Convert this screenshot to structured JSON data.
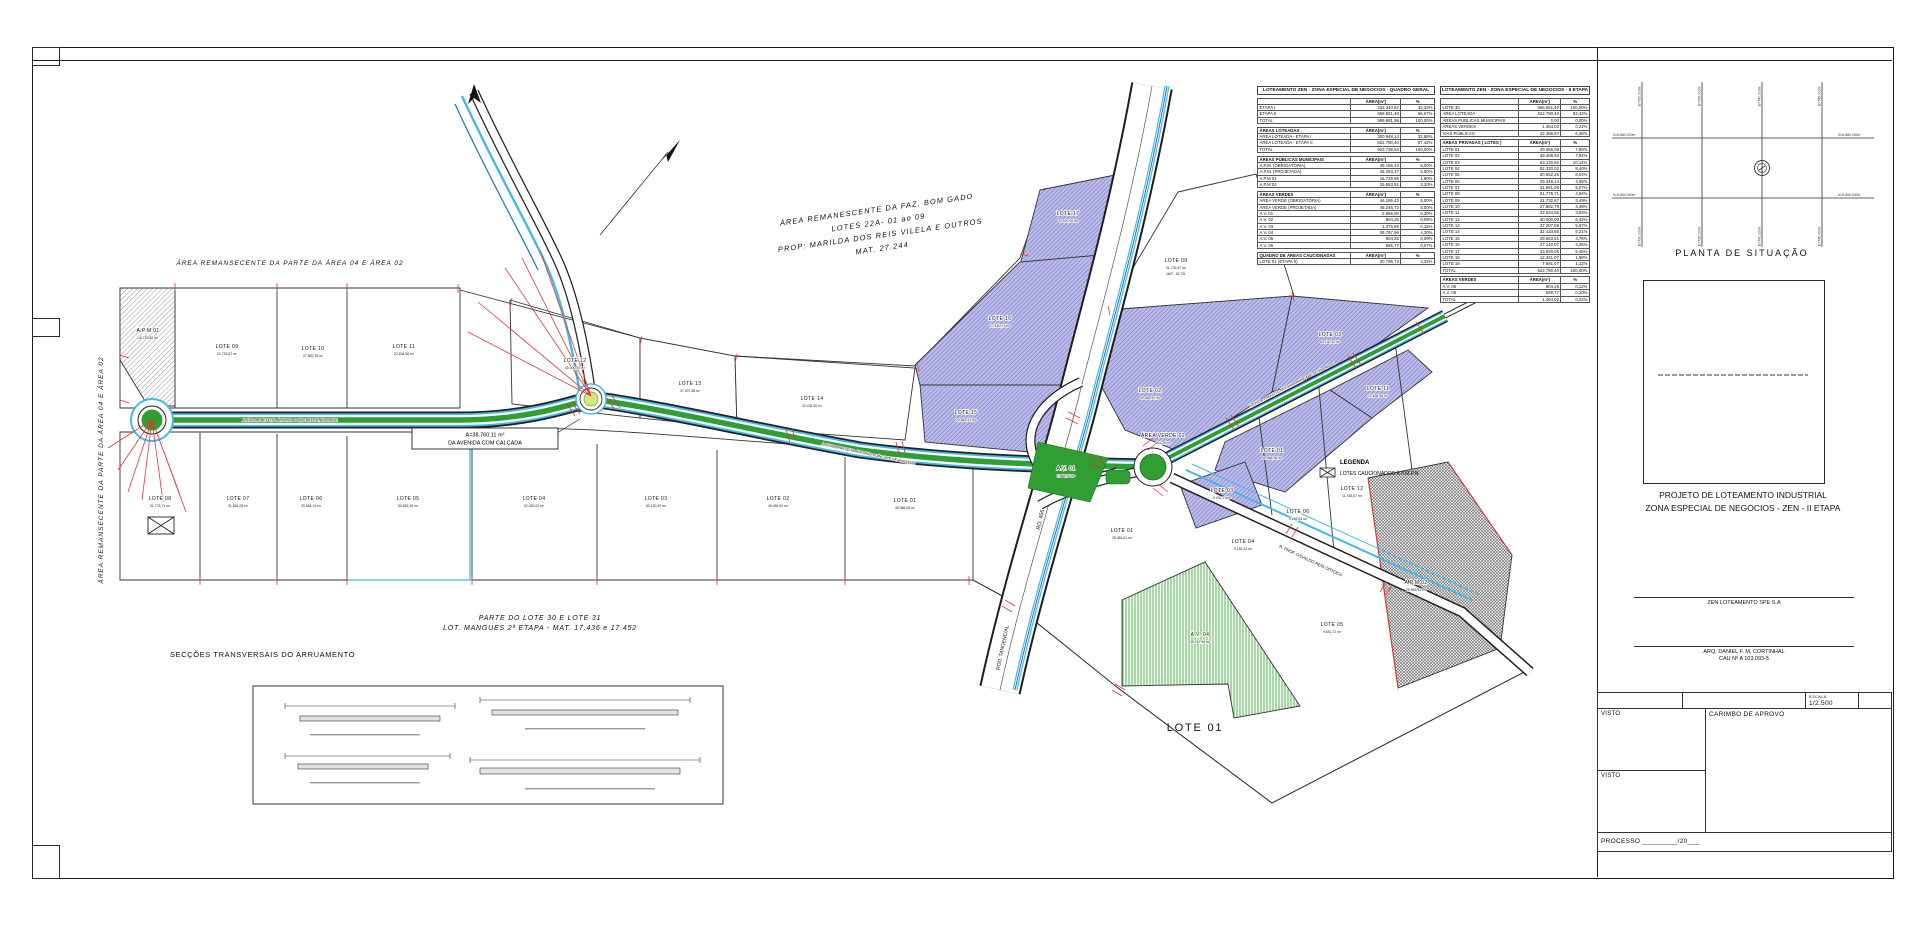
{
  "sheet": {
    "situacao": {
      "title": "PLANTA DE SITUAÇÃO",
      "e_top": [
        "E=730.000m",
        "E=735.000m",
        "E=740.000m",
        "E=745.000m"
      ],
      "e_bottom": [
        "E=730.000m",
        "E=735.000m",
        "E=740.000m",
        "E=745.000m"
      ],
      "n_top": "N=6.880.000m",
      "n_bottom": "N=6.850.000m"
    },
    "project_title_1": "PROJETO DE LOTEAMENTO INDUSTRIAL",
    "project_title_2": "ZONA ESPECIAL DE NEGOCIOS - ZEN - II ETAPA",
    "owner_line": "ZEN LOTEAMENTO SPE S.A",
    "architect_line1": "ARQ. DANIEL F. M. CORTINHAL",
    "architect_line2": "CAU Nº A 103.093-5",
    "escala_label": "ESCALA",
    "escala_value": "1/2.500",
    "visto1": "VISTO",
    "visto2": "VISTO",
    "carimbo": "CARIMBO DE APROVO",
    "processo": "PROCESSO _________/20___"
  },
  "tables": {
    "general": {
      "title": "LOTEAMENTO ZEN - ZONA ESPECIAL DE NEGOCIOS - QUADRO GERAL",
      "sections": [
        {
          "header": [
            "",
            "ÁREA(m²)",
            "%"
          ],
          "rows": [
            [
              "ETAPA I",
              "333.340,57",
              "33,33%"
            ],
            [
              "ETAPA II",
              "666.651,40",
              "66,67%"
            ],
            [
              "TOTAL",
              "999.991,98",
              "100,00%"
            ]
          ]
        },
        {
          "header": [
            "ÁREAS LOTEADAS",
            "ÁREA(m²)",
            "%"
          ],
          "rows": [
            [
              "ÁREA LOTEADA - ETAPA I",
              "300.948,14",
              "32,58%"
            ],
            [
              "ÁREA LOTEADA - ETAPA II",
              "622.790,40",
              "67,42%"
            ],
            [
              "TOTAL",
              "923.738,54",
              "100,00%"
            ]
          ]
        },
        {
          "header": [
            "ÁREAS PÚBLICAS MUNICIPAIS",
            "ÁREA(m²)",
            "%"
          ],
          "rows": [
            [
              "A.P.M. (OBRIGATÓRIA)",
              "46.186,43",
              "5,00%"
            ],
            [
              "A.P.M. (PROJETADA)",
              "46.283,37",
              "5,00%"
            ],
            [
              "A.P.M 01",
              "16.729,86",
              "1,80%"
            ],
            [
              "A.P.M 02",
              "29.553,51",
              "3,20%"
            ]
          ]
        },
        {
          "header": [
            "ÁREAS VERDES",
            "ÁREA(m²)",
            "%"
          ],
          "rows": [
            [
              "ÁREA VERDE (OBRIGATÓRIA)",
              "46.186,43",
              "5,00%"
            ],
            [
              "ÁREA VERDE (PROJETADA)",
              "46.246,73",
              "5,00%"
            ],
            [
              "A.V. 01",
              "2.866,90",
              "0,30%"
            ],
            [
              "A.V. 02",
              "804,25",
              "0,09%"
            ],
            [
              "A.V. 03",
              "1.375,89",
              "0,15%"
            ],
            [
              "A.V. 04",
              "39.767,96",
              "4,30%"
            ],
            [
              "A.V. 05",
              "804,25",
              "0,09%"
            ],
            [
              "A.V. 06",
              "655,77",
              "0,07%"
            ]
          ]
        },
        {
          "header": [
            "QUADRO DE ÁREAS CAUCIONADAS",
            "ÁREA(m²)",
            "%"
          ],
          "rows": [
            [
              "LOTE 01 (ETAPA II)",
              "30.795,73",
              "3,33%"
            ]
          ]
        }
      ]
    },
    "etapa2": {
      "title": "LOTEAMENTO ZEN - ZONA ESPECIAL DE NEGOCIOS - II ETAPA",
      "sections": [
        {
          "header": [
            "",
            "ÁREA(m²)",
            "%"
          ],
          "rows": [
            [
              "LOTE 30",
              "666.651,40",
              "100,00%"
            ],
            [
              "ÁREA LOTEADA",
              "622.790,40",
              "93,42%"
            ],
            [
              "ÁREAS PÚBLICAS MUNICIPAIS",
              "0,00",
              "0,00%"
            ],
            [
              "ÁREAS VERDES",
              "1.464,02",
              "0,22%"
            ],
            [
              "VIAS PÚBLICAS",
              "42.396,97",
              "6,36%"
            ]
          ]
        },
        {
          "header": [
            "ÁREAS PRIVADAS ( LOTES )",
            "ÁREA(m²)",
            "%"
          ],
          "rows": [
            [
              "LOTE 01",
              "49.066,08",
              "7,88%"
            ],
            [
              "LOTE 02",
              "49.489,92",
              "7,94%"
            ],
            [
              "LOTE 03",
              "63.130,92",
              "10,14%"
            ],
            [
              "LOTE 04",
              "52.320,02",
              "8,40%"
            ],
            [
              "LOTE 05",
              "50.652,26",
              "8,04%"
            ],
            [
              "LOTE 06",
              "29.348,14",
              "4,55%"
            ],
            [
              "LOTE 07",
              "31.561,08",
              "5,07%"
            ],
            [
              "LOTE 08",
              "31.775,71",
              "4,94%"
            ],
            [
              "LOTE 09",
              "21.732,67",
              "3,49%"
            ],
            [
              "LOTE 10",
              "27.882,78",
              "4,48%"
            ],
            [
              "LOTE 11",
              "22.634,56",
              "3,63%"
            ],
            [
              "LOTE 12",
              "40.000,00",
              "6,42%"
            ],
            [
              "LOTE 13",
              "37.207,58",
              "5,97%"
            ],
            [
              "LOTE 14",
              "32.434,50",
              "5,21%"
            ],
            [
              "LOTE 15",
              "29.663,51",
              "4,76%"
            ],
            [
              "LOTE 16",
              "27.140,07",
              "4,36%"
            ],
            [
              "LOTE 17",
              "33.920,05",
              "5,45%"
            ],
            [
              "LOTE 18",
              "12.341,07",
              "1,98%"
            ],
            [
              "LOTE 19",
              "7.591,07",
              "1,22%"
            ],
            [
              "TOTAL",
              "622.790,40",
              "100,00%"
            ]
          ]
        },
        {
          "header": [
            "ÁREAS VERDES",
            "ÁREA(m²)",
            "%"
          ],
          "rows": [
            [
              "A.V. 05",
              "804,25",
              "0,12%"
            ],
            [
              "A.V. 06",
              "659,77",
              "0,10%"
            ],
            [
              "TOTAL",
              "1.464,02",
              "0,22%"
            ]
          ]
        }
      ]
    }
  },
  "plan": {
    "notes": {
      "area_rem_top": "ÁREA REMANSECENTE DA PARTE DA ÁREA 04 E ÁREA 02",
      "area_rem_left": "ÁREA REMANSECENTE DA PARTE DA ÁREA 04 E ÁREA 02",
      "parte1": "PARTE DO LOTE 30 E LOTE 31",
      "parte2": "LOT. MANGUES 2ª ETAPA  -  MAT. 17.436 e 17.452",
      "secoes": "SECÇÕES TRANSVERSAIS DO ARRUAMENTO"
    },
    "faz_lines": [
      "ÁREA REMANESCENTE DA FAZ. BOM GADO",
      "LOTES 22A-  01 ao 09",
      "PROP: MARILDA DOS REIS VILELA E OUTROS",
      "MAT. 27.244"
    ],
    "callout": {
      "line1": "A=38.760,11 m²",
      "line2": "DA AVENIDA COM CALÇADA"
    },
    "legend": {
      "title": "LEGENDA",
      "item": "LOTES CAUCIONADOS À P.M.P.N"
    },
    "roads": {
      "avenue_name": "AVENIDA PREFEITO ANTONIO POINCARE DE ANDRADE",
      "highway": "RO. 456",
      "highway2": "ROD. TANGENCIAL",
      "street_se": "R. PROF. OSVALDO REIS OITICICA"
    },
    "big_lot": "LOTE 01",
    "lots": [
      {
        "name": "LOTE 09",
        "area": "21.732,67 m²",
        "x": 227,
        "y": 348
      },
      {
        "name": "LOTE 10",
        "area": "27.882,78 m²",
        "x": 313,
        "y": 350
      },
      {
        "name": "LOTE 11",
        "area": "22.634,56 m²",
        "x": 404,
        "y": 348
      },
      {
        "name": "LOTE 12",
        "area": "40.000,00 m²",
        "x": 575,
        "y": 362
      },
      {
        "name": "LOTE 13",
        "area": "37.207,58 m²",
        "x": 690,
        "y": 385
      },
      {
        "name": "LOTE 14",
        "area": "32.434,50 m²",
        "x": 812,
        "y": 400
      },
      {
        "name": "LOTE 08",
        "area": "31.775,71 m²",
        "x": 160,
        "y": 500
      },
      {
        "name": "LOTE 07",
        "area": "31.561,08 m²",
        "x": 238,
        "y": 500
      },
      {
        "name": "LOTE 06",
        "area": "29.348,14 m²",
        "x": 311,
        "y": 500
      },
      {
        "name": "LOTE 05",
        "area": "50.652,26 m²",
        "x": 408,
        "y": 500
      },
      {
        "name": "LOTE 04",
        "area": "52.320,02 m²",
        "x": 534,
        "y": 500
      },
      {
        "name": "LOTE 03",
        "area": "63.130,92 m²",
        "x": 656,
        "y": 500
      },
      {
        "name": "LOTE 02",
        "area": "49.489,92 m²",
        "x": 778,
        "y": 500
      },
      {
        "name": "LOTE 01",
        "area": "49.066,08 m²",
        "x": 905,
        "y": 502
      },
      {
        "name": "LOTE 17",
        "area": "33.920,05 m²",
        "x": 1068,
        "y": 215
      },
      {
        "name": "LOTE 16",
        "area": "27.140,07 m²",
        "x": 1000,
        "y": 320
      },
      {
        "name": "LOTE 15",
        "area": "29.663,51 m²",
        "x": 966,
        "y": 414
      },
      {
        "name": "LOTE 09",
        "area": "21.732,67 m²",
        "extra": "MAT - 93.731",
        "x": 1176,
        "y": 262
      },
      {
        "name": "LOTE 02",
        "area": "49.489,92 m²",
        "x": 1150,
        "y": 392
      },
      {
        "name": "LOTE 03",
        "area": "63.130,92 m²",
        "x": 1330,
        "y": 336
      },
      {
        "name": "LOTE 11",
        "area": "22.634,56 m²",
        "x": 1378,
        "y": 390
      },
      {
        "name": "LOTE 01",
        "area": "49.066,08 m²",
        "x": 1272,
        "y": 452
      },
      {
        "name": "LOTE 03",
        "area": "9.431,27 m²",
        "x": 1222,
        "y": 492
      },
      {
        "name": "LOTE 04",
        "area": "9.182,42 m²",
        "x": 1243,
        "y": 543
      },
      {
        "name": "LOTE 06",
        "area": "9.265,53 m²",
        "x": 1298,
        "y": 513
      },
      {
        "name": "LOTE 12",
        "area": "11.765,67 m²",
        "x": 1352,
        "y": 490
      },
      {
        "name": "LOTE 05",
        "area": "9.641,72 m²",
        "x": 1332,
        "y": 626
      },
      {
        "name": "LOTE 01",
        "area": "28.364,61 m²",
        "x": 1122,
        "y": 532
      },
      {
        "name": "A.V. 04",
        "area": "39.767,96 m²",
        "x": 1200,
        "y": 636
      },
      {
        "name": "A.P.M 02",
        "area": "29.553,51 m²",
        "x": 1416,
        "y": 584
      },
      {
        "name": "ÁREA VERDE 02",
        "area": "804,25 m²",
        "x": 1163,
        "y": 437
      },
      {
        "name": "A.V. 01",
        "area": "2.866,90 m²",
        "x": 1066,
        "y": 470
      },
      {
        "name": "A.P.M 01",
        "area": "16.729,86 m²",
        "x": 148,
        "y": 332
      }
    ]
  }
}
